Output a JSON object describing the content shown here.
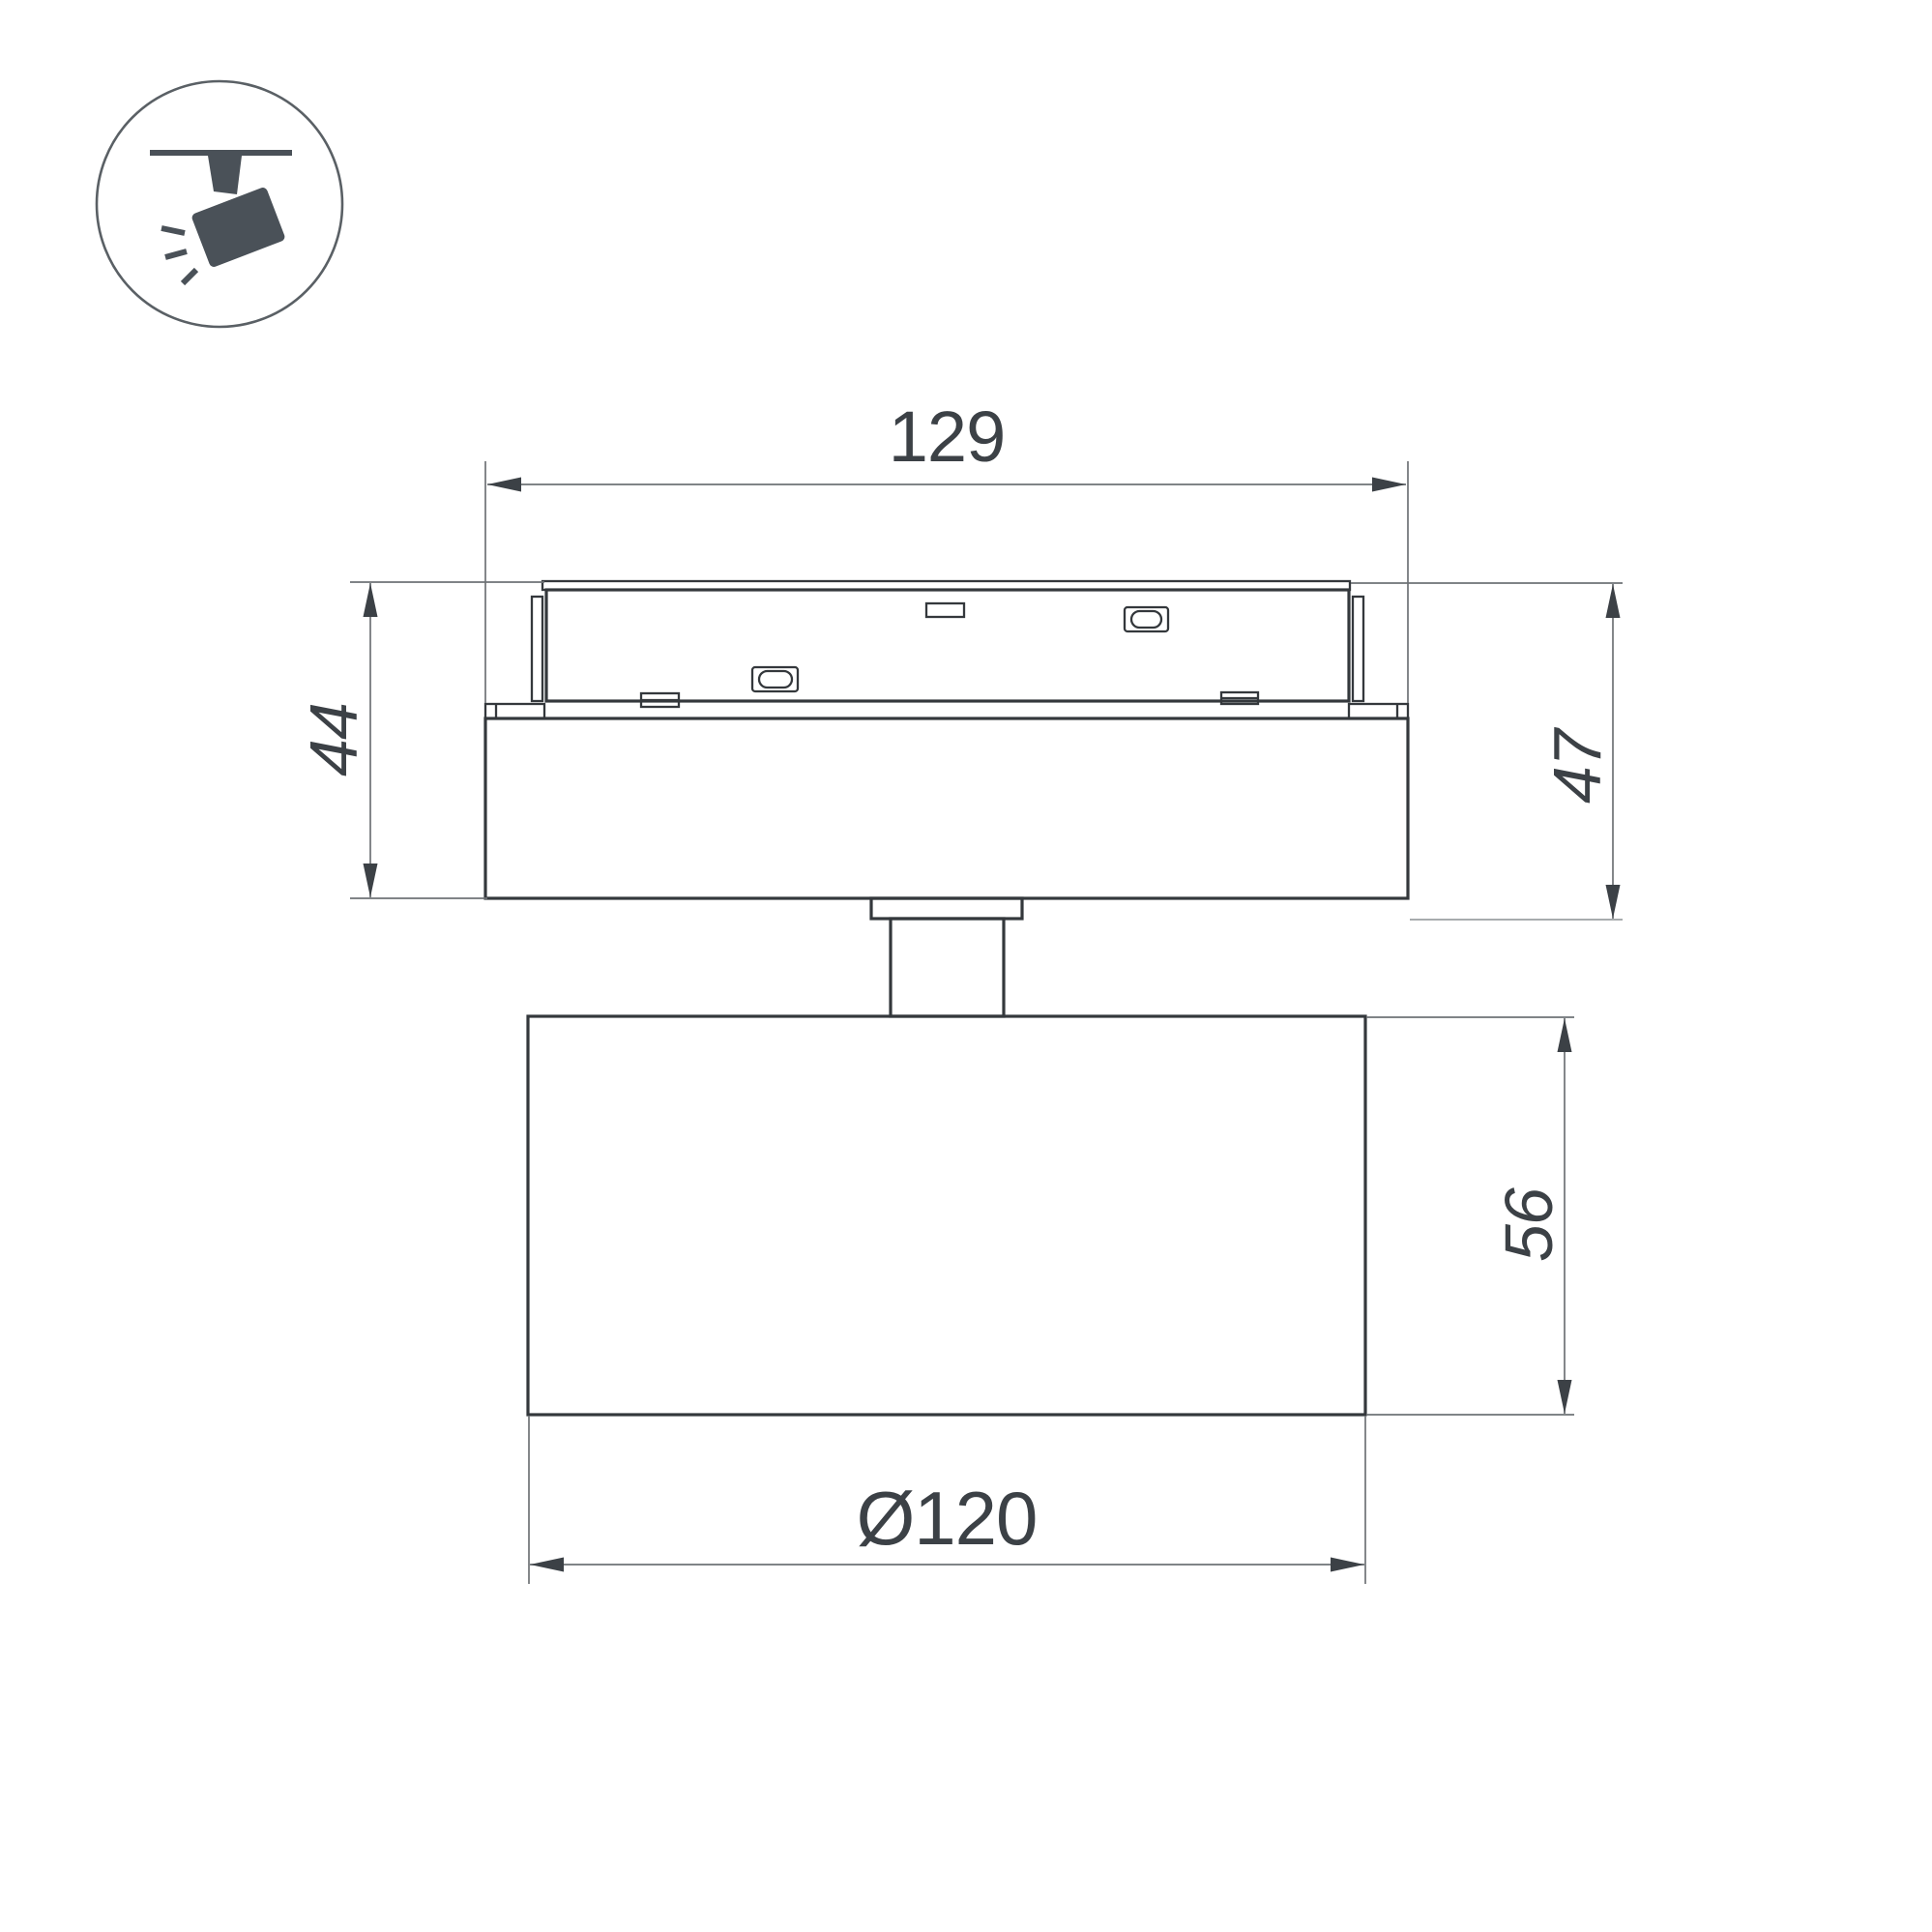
{
  "page": {
    "background": "#ffffff",
    "type": "technical-dimension-drawing",
    "subject": "magnetic-track-spotlight-side-view"
  },
  "colors": {
    "outline": "#34383c",
    "dim-line": "#6e7276",
    "dim-light": "#9ca0a3",
    "dim-text": "#3c4146",
    "arrow": "#3c4146",
    "icon": "#4a5158",
    "icon-ring": "#5a6065"
  },
  "dimensions": {
    "track_width": "129",
    "adapter_height": "44",
    "total_height": "47",
    "body_height": "56",
    "body_diameter": "Ø120"
  },
  "icon": {
    "name": "track-spotlight"
  }
}
